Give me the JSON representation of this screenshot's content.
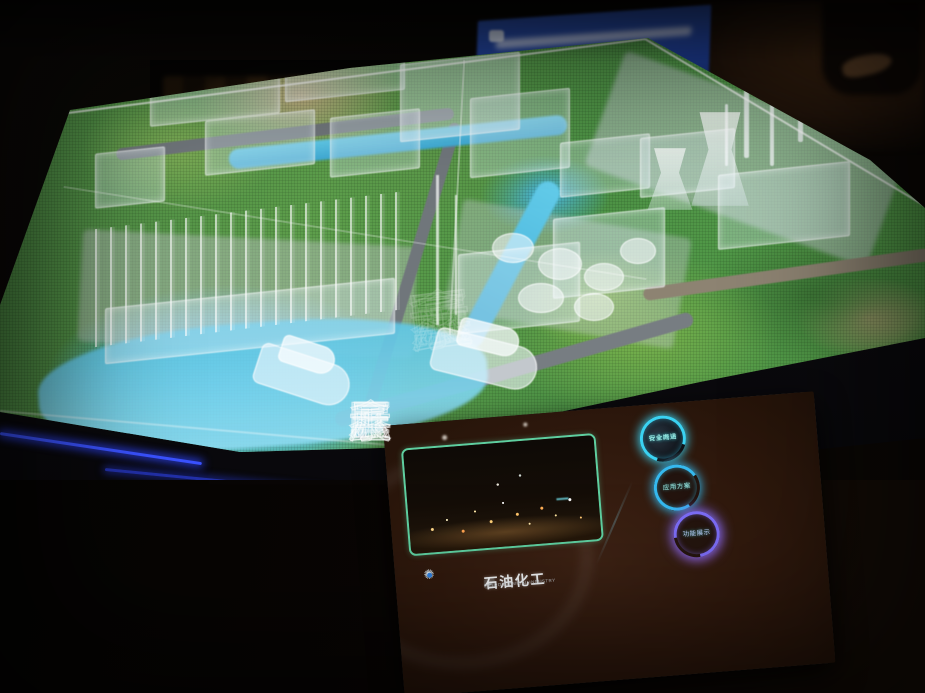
{
  "scene": {
    "subject": "exhibition-scale-model-with-touch-panel",
    "model_colors": {
      "river": "#55c6e8",
      "grass": "#5d9e4b",
      "edge_glow": "#2742ff",
      "signage_blue": "#1d3b90"
    }
  },
  "watermark": {
    "chars": [
      "鑫",
      "匠",
      "展",
      "示"
    ]
  },
  "tablet": {
    "screen": {
      "gear_icon": "✺",
      "menu_icon": "≡",
      "title_cn": "石油化工",
      "title_en": "PETROCHEMICAL INDUSTRY",
      "buttons": [
        {
          "line1": "行业内涵",
          "line2": "安全概述",
          "ring_color": "#3ad2f2"
        },
        {
          "line1": "应用方案",
          "line2": "",
          "ring_color": "#35b9ef"
        },
        {
          "line1": "功能展示",
          "line2": "",
          "ring_color": "#7b6cf5"
        }
      ]
    }
  }
}
